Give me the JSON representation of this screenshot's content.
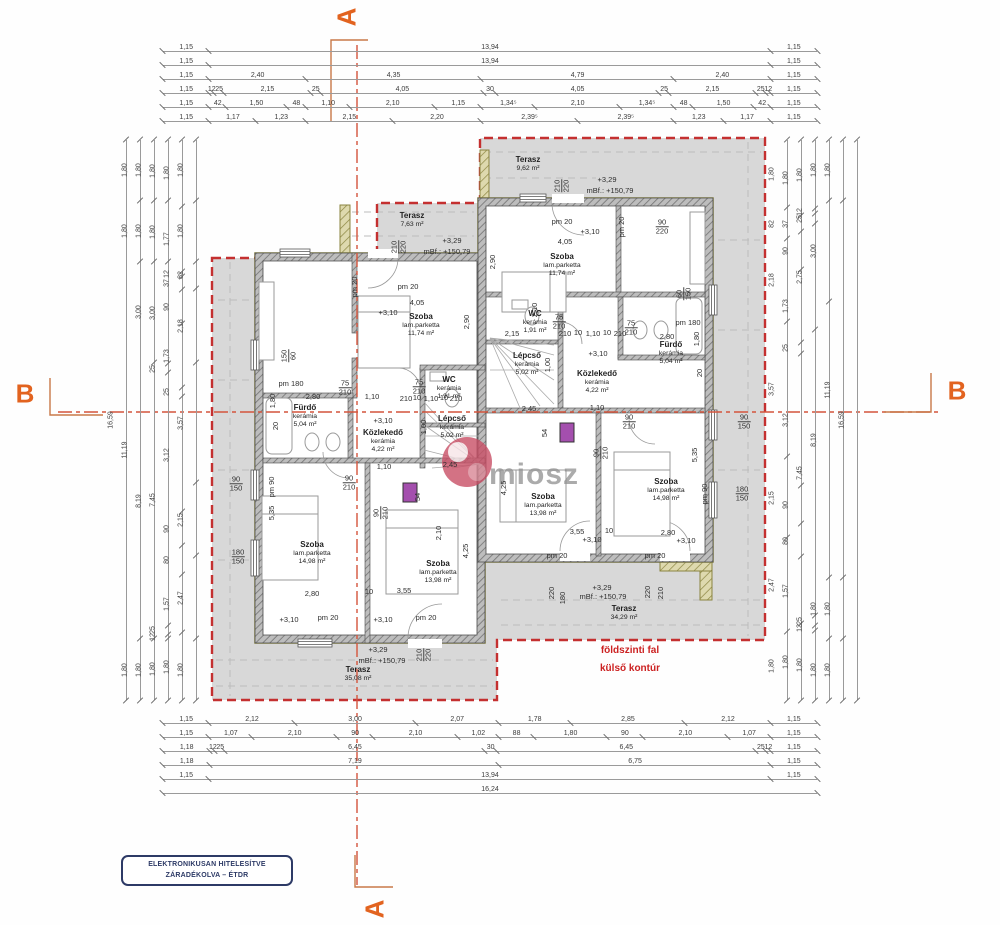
{
  "section_markers": {
    "a": "A",
    "b": "B"
  },
  "stamp": {
    "line1": "ELEKTRONIKUSAN HITELESÍTVE",
    "line2": "ZÁRADÉKOLVA – ÉTDR"
  },
  "watermark_text": "miosz",
  "red_note": {
    "line1": "földszinti fal",
    "line2": "külső kontúr"
  },
  "colors": {
    "section_marker_orange": "#e2631f",
    "section_line": "#d4543c",
    "contour_red": "#c43030",
    "wall_gray": "#7a7a7a",
    "terrace_gray": "#d8d8d8",
    "olive_outline": "#9a9441",
    "shaft_purple": "#a44fae",
    "stamp_navy": "#2d3a66",
    "watermark_pink": "#c94f66"
  },
  "dim_chains": {
    "top": {
      "x": 85,
      "width": 838,
      "pad_left": 78,
      "pad_right": 106,
      "rows": [
        {
          "y": 40,
          "segs": [
            "1,15",
            "13,94",
            "1,15"
          ]
        },
        {
          "y": 54,
          "segs": [
            "1,15",
            "13,94",
            "1,15"
          ]
        },
        {
          "y": 68,
          "segs": [
            "1,15",
            "2,40",
            "4,35",
            "4,79",
            "2,40",
            "1,15"
          ]
        },
        {
          "y": 82,
          "segs": [
            "1,15",
            "12",
            "25",
            "2,15",
            "25",
            "4,05",
            "30",
            "4,05",
            "25",
            "2,15",
            "25",
            "12",
            "1,15"
          ]
        },
        {
          "y": 96,
          "segs": [
            "1,15",
            "42",
            "1,50",
            "48",
            "1,10",
            "2,10",
            "1,15",
            "1,34⁵",
            "2,10",
            "1,34⁵",
            "48",
            "1,50",
            "42",
            "1,15"
          ]
        },
        {
          "y": 110,
          "segs": [
            "1,15",
            "1,17",
            "1,23",
            "2,15",
            "2,20",
            "2,39⁵",
            "2,39⁵",
            "1,23",
            "1,17",
            "1,15"
          ]
        }
      ]
    },
    "bottom": {
      "x": 85,
      "width": 838,
      "pad_left": 78,
      "pad_right": 106,
      "rows": [
        {
          "y": 712,
          "segs": [
            "1,15",
            "2,12",
            "3,00",
            "2,07",
            "1,78",
            "2,85",
            "2,12",
            "1,15"
          ]
        },
        {
          "y": 726,
          "segs": [
            "1,15",
            "1,07",
            "2,10",
            "90",
            "2,10",
            "1,02",
            "88",
            "1,80",
            "90",
            "2,10",
            "1,07",
            "1,15"
          ]
        },
        {
          "y": 740,
          "segs": [
            "1,18",
            "12",
            "25",
            "6,45",
            "30",
            "6,45",
            "25",
            "12",
            "1,15"
          ]
        },
        {
          "y": 754,
          "segs": [
            "1,18",
            "7,19",
            "6,75",
            "1,15"
          ]
        },
        {
          "y": 768,
          "segs": [
            "1,15",
            "13,94",
            "1,15"
          ]
        },
        {
          "y": 782,
          "segs": [
            "16,24"
          ]
        }
      ]
    },
    "left": {
      "y": 140,
      "height": 560,
      "cols": [
        {
          "x": 125,
          "segs": [
            "16,59"
          ]
        },
        {
          "x": 139,
          "segs": [
            "1,80",
            "1,80",
            "11,19",
            "1,80"
          ]
        },
        {
          "x": 153,
          "segs": [
            "1,80",
            "1,80",
            "3,00",
            "8,19",
            "1,80"
          ]
        },
        {
          "x": 167,
          "segs": [
            "1,80",
            "1,80",
            "3,00",
            "25",
            "7,45",
            "25",
            "12",
            "1,80"
          ]
        },
        {
          "x": 181,
          "segs": [
            "1,80",
            "1,77",
            "12",
            "37",
            "90",
            "1,73",
            "25",
            "3,12",
            "90",
            "80",
            "1,57",
            "1,80"
          ]
        },
        {
          "x": 195,
          "segs": [
            "1,80",
            "1,80",
            "82",
            "2,18",
            "3,57",
            "2,15",
            "2,47",
            "1,80"
          ]
        }
      ]
    },
    "right": {
      "y": 140,
      "height": 560,
      "cols": [
        {
          "x": 786,
          "segs": [
            "1,80",
            "82",
            "2,18",
            "3,57",
            "2,15",
            "2,47",
            "1,80"
          ]
        },
        {
          "x": 800,
          "segs": [
            "1,80",
            "37",
            "90",
            "1,73",
            "25",
            "3,12",
            "90",
            "80",
            "1,57",
            "1,80"
          ]
        },
        {
          "x": 814,
          "segs": [
            "1,80",
            "12",
            "25",
            "2,75",
            "7,45",
            "25",
            "12",
            "1,80"
          ]
        },
        {
          "x": 828,
          "segs": [
            "1,80",
            "3,00",
            "8,19",
            "1,80",
            "1,80"
          ]
        },
        {
          "x": 842,
          "segs": [
            "1,80",
            "11,19",
            "1,80",
            "1,80"
          ]
        },
        {
          "x": 856,
          "segs": [
            "16,59"
          ]
        }
      ]
    }
  },
  "rooms": [
    {
      "n": "Terasz",
      "a": "7,63 m²",
      "x": 412,
      "y": 220
    },
    {
      "n": "Szoba",
      "m": "lam.parketta",
      "a": "11,74 m²",
      "x": 421,
      "y": 325
    },
    {
      "n": "WC",
      "m": "kerámia",
      "a": "1,91 m²",
      "x": 449,
      "y": 388
    },
    {
      "n": "Fürdő",
      "m": "kerámia",
      "a": "5,04 m²",
      "x": 305,
      "y": 416
    },
    {
      "n": "Közlekedő",
      "m": "kerámia",
      "a": "4,22 m²",
      "x": 383,
      "y": 441
    },
    {
      "n": "Lépcső",
      "m": "kerámia",
      "a": "5,02 m²",
      "x": 452,
      "y": 427
    },
    {
      "n": "Szoba",
      "m": "lam.parketta",
      "a": "14,98 m²",
      "x": 312,
      "y": 553
    },
    {
      "n": "Szoba",
      "m": "lam.parketta",
      "a": "13,98 m²",
      "x": 438,
      "y": 572
    },
    {
      "n": "Terasz",
      "a": "35,08 m²",
      "x": 358,
      "y": 674
    },
    {
      "n": "Terasz",
      "a": "9,62 m²",
      "x": 528,
      "y": 164
    },
    {
      "n": "Szoba",
      "m": "lam.parketta",
      "a": "11,74 m²",
      "x": 562,
      "y": 265
    },
    {
      "n": "WC",
      "m": "kerámia",
      "a": "1,91 m²",
      "x": 535,
      "y": 322
    },
    {
      "n": "Fürdő",
      "m": "kerámia",
      "a": "5,04 m²",
      "x": 671,
      "y": 353
    },
    {
      "n": "Közlekedő",
      "m": "kerámia",
      "a": "4,22 m²",
      "x": 597,
      "y": 382
    },
    {
      "n": "Lépcső",
      "m": "kerámia",
      "a": "5,02 m²",
      "x": 527,
      "y": 364
    },
    {
      "n": "Szoba",
      "m": "lam.parketta",
      "a": "13,98 m²",
      "x": 543,
      "y": 505
    },
    {
      "n": "Szoba",
      "m": "lam.parketta",
      "a": "14,98 m²",
      "x": 666,
      "y": 490
    },
    {
      "n": "Terasz",
      "a": "34,29 m²",
      "x": 624,
      "y": 613
    }
  ],
  "annotations": [
    {
      "t": "+3,29",
      "x": 452,
      "y": 241
    },
    {
      "t": "mBf.: +150,79",
      "x": 447,
      "y": 252
    },
    {
      "t": "210\n220",
      "x": 399,
      "y": 247,
      "r": 1,
      "f": 1
    },
    {
      "t": "pm 20",
      "x": 355,
      "y": 287,
      "r": 1
    },
    {
      "t": "pm 20",
      "x": 408,
      "y": 287
    },
    {
      "t": "4,05",
      "x": 417,
      "y": 303
    },
    {
      "t": "+3,10",
      "x": 388,
      "y": 313
    },
    {
      "t": "2,90",
      "x": 467,
      "y": 322,
      "r": 1
    },
    {
      "t": "150\n60",
      "x": 289,
      "y": 356,
      "r": 1,
      "f": 1
    },
    {
      "t": "pm 180",
      "x": 291,
      "y": 384
    },
    {
      "t": "2,80",
      "x": 313,
      "y": 397
    },
    {
      "t": "75\n210",
      "x": 345,
      "y": 388,
      "f": 1
    },
    {
      "t": "1,10",
      "x": 372,
      "y": 397
    },
    {
      "t": "75\n210",
      "x": 419,
      "y": 387,
      "f": 1
    },
    {
      "t": "210",
      "x": 406,
      "y": 399
    },
    {
      "t": "10",
      "x": 417,
      "y": 398
    },
    {
      "t": "1,10",
      "x": 431,
      "y": 399
    },
    {
      "t": "10",
      "x": 444,
      "y": 398
    },
    {
      "t": "210",
      "x": 456,
      "y": 399
    },
    {
      "t": "1,80",
      "x": 273,
      "y": 401,
      "r": 1
    },
    {
      "t": "20",
      "x": 276,
      "y": 426,
      "r": 1
    },
    {
      "t": "+3,10",
      "x": 383,
      "y": 421
    },
    {
      "t": "1,00",
      "x": 424,
      "y": 427,
      "r": 1
    },
    {
      "t": "2,45",
      "x": 450,
      "y": 465
    },
    {
      "t": "1,10",
      "x": 384,
      "y": 467
    },
    {
      "t": "90\n210",
      "x": 349,
      "y": 483,
      "f": 1
    },
    {
      "t": "90\n210",
      "x": 381,
      "y": 513,
      "r": 1,
      "f": 1
    },
    {
      "t": "54",
      "x": 418,
      "y": 497,
      "r": 1
    },
    {
      "t": "90\n150",
      "x": 236,
      "y": 484,
      "f": 1
    },
    {
      "t": "pm 90",
      "x": 272,
      "y": 487,
      "r": 1
    },
    {
      "t": "5,35",
      "x": 272,
      "y": 513,
      "r": 1
    },
    {
      "t": "180\n150",
      "x": 238,
      "y": 557,
      "f": 1
    },
    {
      "t": "2,80",
      "x": 312,
      "y": 594
    },
    {
      "t": "10",
      "x": 369,
      "y": 592
    },
    {
      "t": "3,55",
      "x": 404,
      "y": 591
    },
    {
      "t": "4,25",
      "x": 466,
      "y": 551,
      "r": 1
    },
    {
      "t": "2,10",
      "x": 439,
      "y": 533,
      "r": 1
    },
    {
      "t": "+3,10",
      "x": 289,
      "y": 620
    },
    {
      "t": "pm 20",
      "x": 328,
      "y": 618
    },
    {
      "t": "+3,10",
      "x": 383,
      "y": 620
    },
    {
      "t": "pm 20",
      "x": 426,
      "y": 618
    },
    {
      "t": "+3,29",
      "x": 378,
      "y": 650
    },
    {
      "t": "mBf.: +150,79",
      "x": 382,
      "y": 661
    },
    {
      "t": "210\n220",
      "x": 424,
      "y": 655,
      "r": 1,
      "f": 1
    },
    {
      "t": "+3,29",
      "x": 607,
      "y": 180
    },
    {
      "t": "mBf.: +150,79",
      "x": 610,
      "y": 191
    },
    {
      "t": "210\n220",
      "x": 562,
      "y": 186,
      "r": 1,
      "f": 1
    },
    {
      "t": "pm 20",
      "x": 562,
      "y": 222
    },
    {
      "t": "pm 20",
      "x": 622,
      "y": 227,
      "r": 1
    },
    {
      "t": "+3,10",
      "x": 590,
      "y": 232
    },
    {
      "t": "4,05",
      "x": 565,
      "y": 242
    },
    {
      "t": "90\n220",
      "x": 662,
      "y": 227,
      "f": 1
    },
    {
      "t": "2,90",
      "x": 493,
      "y": 262,
      "r": 1
    },
    {
      "t": "2,15",
      "x": 512,
      "y": 334
    },
    {
      "t": "75\n210",
      "x": 559,
      "y": 322,
      "f": 1
    },
    {
      "t": "210",
      "x": 565,
      "y": 334
    },
    {
      "t": "10",
      "x": 578,
      "y": 333
    },
    {
      "t": "1,10",
      "x": 593,
      "y": 334
    },
    {
      "t": "10",
      "x": 607,
      "y": 333
    },
    {
      "t": "210",
      "x": 620,
      "y": 334
    },
    {
      "t": "75\n210",
      "x": 631,
      "y": 328,
      "f": 1
    },
    {
      "t": "pm 180",
      "x": 688,
      "y": 323
    },
    {
      "t": "2,80",
      "x": 667,
      "y": 337
    },
    {
      "t": "60\n150",
      "x": 684,
      "y": 294,
      "r": 1,
      "f": 1
    },
    {
      "t": "1,80",
      "x": 697,
      "y": 339,
      "r": 1
    },
    {
      "t": "20",
      "x": 700,
      "y": 373,
      "r": 1
    },
    {
      "t": "+3,10",
      "x": 598,
      "y": 354
    },
    {
      "t": "1,00",
      "x": 548,
      "y": 365,
      "r": 1
    },
    {
      "t": "2,10",
      "x": 535,
      "y": 310,
      "r": 1
    },
    {
      "t": "2,45",
      "x": 529,
      "y": 409
    },
    {
      "t": "1,10",
      "x": 597,
      "y": 408
    },
    {
      "t": "90\n210",
      "x": 629,
      "y": 422,
      "f": 1
    },
    {
      "t": "90\n210",
      "x": 601,
      "y": 453,
      "r": 1,
      "f": 1
    },
    {
      "t": "54",
      "x": 545,
      "y": 433,
      "r": 1
    },
    {
      "t": "90\n150",
      "x": 744,
      "y": 422,
      "f": 1
    },
    {
      "t": "pm 90",
      "x": 705,
      "y": 494,
      "r": 1
    },
    {
      "t": "5,35",
      "x": 695,
      "y": 455,
      "r": 1
    },
    {
      "t": "180\n150",
      "x": 742,
      "y": 494,
      "f": 1
    },
    {
      "t": "2,80",
      "x": 668,
      "y": 533
    },
    {
      "t": "10",
      "x": 609,
      "y": 531
    },
    {
      "t": "3,55",
      "x": 577,
      "y": 532
    },
    {
      "t": "4,25",
      "x": 504,
      "y": 488,
      "r": 1
    },
    {
      "t": "+3,10",
      "x": 592,
      "y": 540
    },
    {
      "t": "pm 20",
      "x": 557,
      "y": 556
    },
    {
      "t": "+3,10",
      "x": 686,
      "y": 541
    },
    {
      "t": "pm 20",
      "x": 655,
      "y": 556
    },
    {
      "t": "+3,29",
      "x": 602,
      "y": 588
    },
    {
      "t": "mBf.: +150,79",
      "x": 603,
      "y": 597
    },
    {
      "t": "220",
      "x": 552,
      "y": 593,
      "r": 1
    },
    {
      "t": "180",
      "x": 563,
      "y": 598,
      "r": 1
    },
    {
      "t": "220",
      "x": 648,
      "y": 592,
      "r": 1
    },
    {
      "t": "210",
      "x": 661,
      "y": 593,
      "r": 1
    }
  ]
}
